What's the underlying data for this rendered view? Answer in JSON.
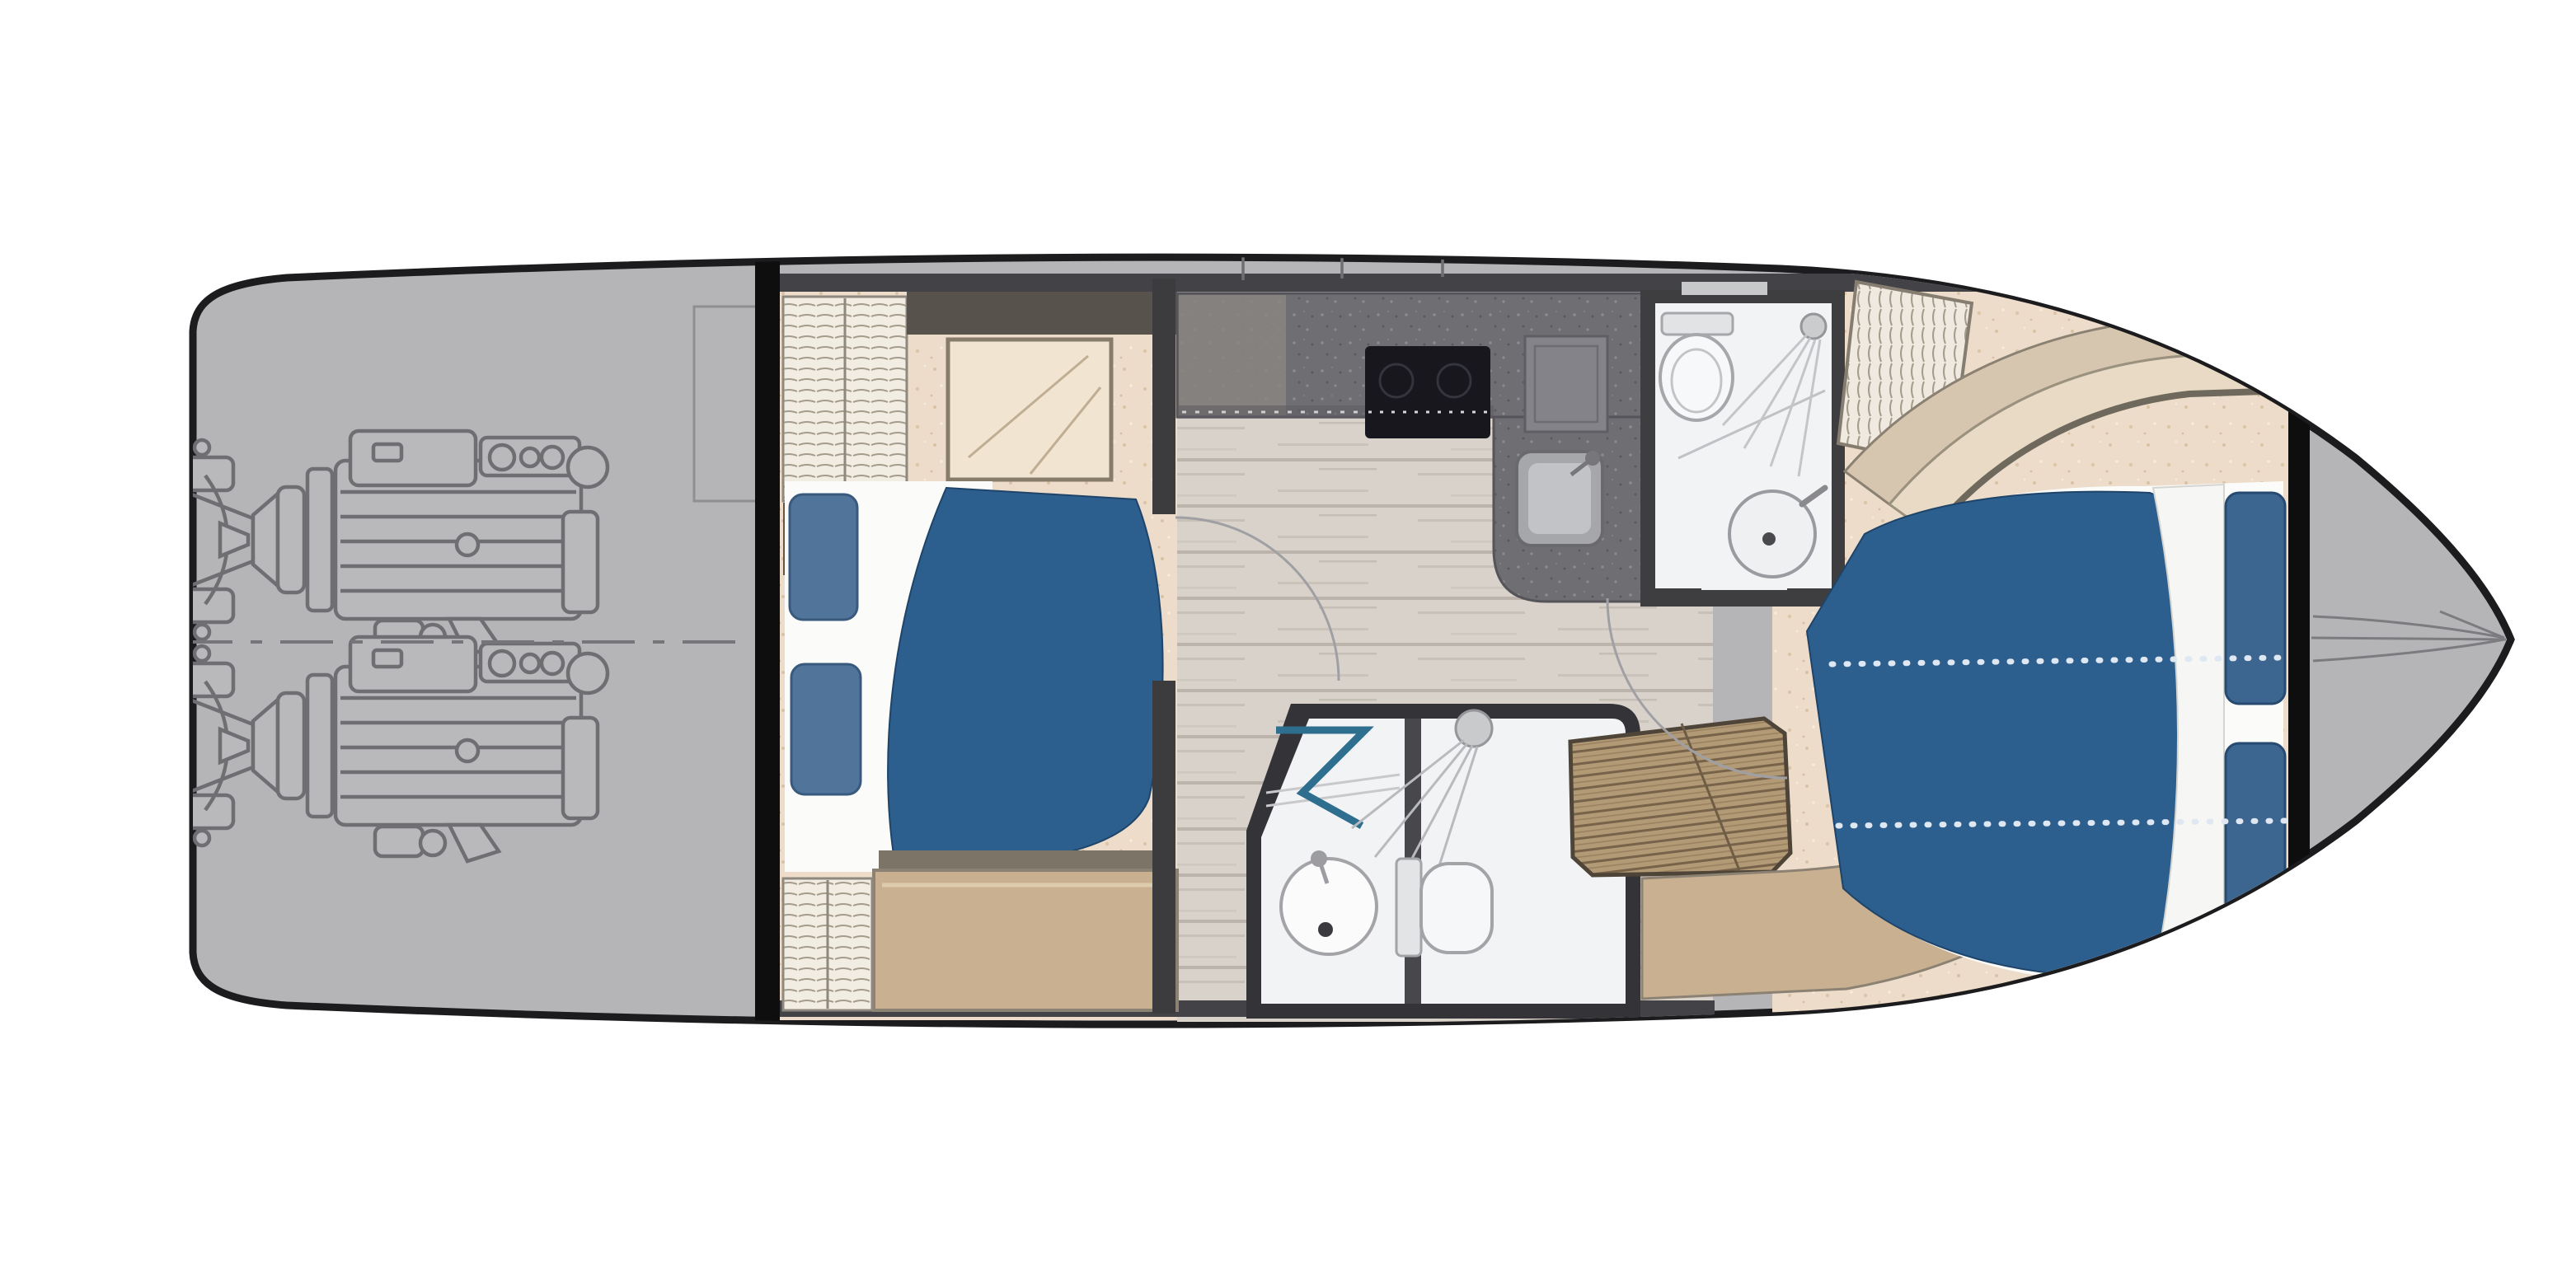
{
  "title": "Motor yacht lower deck floor plan",
  "colors": {
    "background": "#ffffff",
    "deck_gray": "#b5b4b6",
    "hull_outline": "#1c1c1e",
    "wall_dark": "#434246",
    "bulkhead_black": "#0e0e0f",
    "carpet_cream": "#ecdcc9",
    "bed_blue": "#2d5f8e",
    "pillow_slate": "#51749b",
    "pillow_navy": "#3c6590",
    "bedding_white": "#fbfbfa",
    "counter_dark": "#6f6e72",
    "cooktop_black": "#17171d",
    "wood_floor": "#d8d2ca",
    "tan_seat": "#c9b091",
    "teak_wood": "#b29a76",
    "fixture_white": "#f2f3f4",
    "door_teal": "#2e6e8e",
    "line_gray": "#6f6f73"
  },
  "features": {
    "engine_count": 2,
    "berth_count": 2,
    "head_compartments": 2,
    "visible_elements": [
      "twin-engines",
      "engine-room-centerline",
      "aft-cabin-double-berth",
      "aft-cabin-wardrobe",
      "galley-counter",
      "cooktop",
      "galley-sink",
      "mid-head-sink",
      "mid-head-toilet",
      "mid-head-shower",
      "forward-head-toilet",
      "forward-head-sink",
      "forward-head-shower",
      "teak-slat-bench",
      "v-berth-double-bed",
      "bow-pulpit"
    ]
  }
}
